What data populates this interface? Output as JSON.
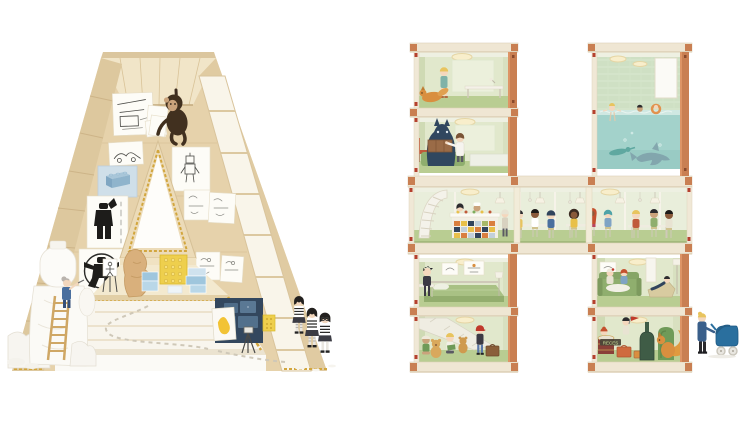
{
  "meta": {
    "canvas": {
      "width": 750,
      "height": 421
    },
    "background": "#ffffff",
    "caption_hidden": "Letter-shaped playhouses: wooden letter A atelier and letter H doll-house building"
  },
  "a_structure": {
    "letter": "A",
    "aria_label": "Wooden letter-A playhouse filled with children's artwork and sculptures",
    "colors": {
      "wood_light": "#e9d8b6",
      "wood_wall": "#e6d2ab",
      "wood_edge": "#ddc89e",
      "ceiling": "#f1e5c8",
      "gold_trim": "#d2a63e",
      "floor_deck": "#f8f5ed",
      "panel_navy": "#33475e",
      "brick_blue": "#8fb4cc",
      "plate_yellow": "#eecf4d",
      "monkey_brown": "#41301f",
      "statue_wood": "#d9b07c"
    },
    "elements": {
      "monkey": "chimpanzee hanging from the ceiling",
      "artworks": [
        "desk sketches",
        "car sketch",
        "blue brick painting",
        "robot sketch",
        "black minifigure poster",
        "figure sketch cluster",
        "vitruvian minifigure roundel",
        "storyboard sketches"
      ],
      "white_sculpture": "white draped minifigure sculpture",
      "sculptor": "grey-haired sculptor on a wooden ladder",
      "wood_statue": "carved wooden figure",
      "brick_stacks": "stacked toy bricks and yellow stud plate",
      "kitchen_panel": "navy play-kitchen panel with yellow canvas and camera tripod",
      "visitors": "three children in striped shirts"
    }
  },
  "h_structure": {
    "letter": "H",
    "aria_label": "Letter-H doll-house building with stacked rooms and a cafeteria crossbar",
    "colors": {
      "frame": "#f0e8d6",
      "slab": "#efe6d3",
      "terracotta": "#c97f52",
      "clip_red": "#b5402e",
      "wall": "#e1e8cc",
      "wall_side": "#cfdab4",
      "floor": "#b9cd92",
      "pool_water": "#a3d2cb",
      "pool_tile": "#cfe0c4",
      "sofa_green": "#8fae6e",
      "pram_blue": "#2a6f9e"
    },
    "rooms": [
      {
        "id": "top-left-upper",
        "desc": "child walking a fox past a white desk"
      },
      {
        "id": "top-left-lower",
        "desc": "child in a lab coat with a blue creature and crate"
      },
      {
        "id": "pool",
        "desc": "double-height swimming pool with swimmers and a dolphin"
      },
      {
        "id": "crossbar",
        "desc": "cafeteria with spiral stair, tiled serving counter and children at tables"
      },
      {
        "id": "mid-left",
        "desc": "bedroom with a green bed and desk"
      },
      {
        "id": "bottom-left",
        "desc": "children playing with teddy bears under a stair"
      },
      {
        "id": "mid-right",
        "desc": "lounge with green sofa and deck chair"
      },
      {
        "id": "bottom-right",
        "desc": "music room with drum, bass case, green chair and squirrel",
        "sign_text": "RECES"
      }
    ],
    "passerby": "parent pushing a blue pram"
  }
}
